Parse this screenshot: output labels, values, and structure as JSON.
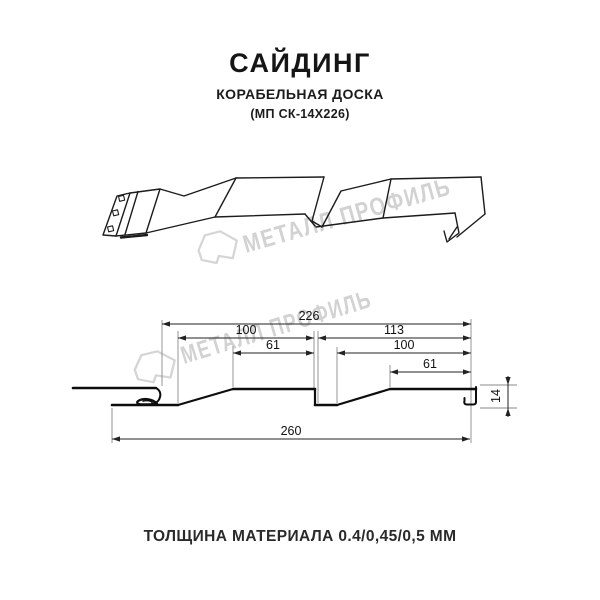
{
  "header": {
    "title": "САЙДИНГ",
    "subtitle": "КОРАБЕЛЬНАЯ ДОСКА",
    "model": "(МП СК-14Х226)"
  },
  "watermark": {
    "brand": "МЕТАЛЛ ПРОФИЛЬ",
    "color": "#d2d2d2"
  },
  "drawing": {
    "type": "siding profile cross-section with dimensions",
    "line_color": "#111111",
    "dimensions": {
      "overall_top": "226",
      "left_board_width": "100",
      "right_board_width": "113",
      "left_face_width": "61",
      "right_board_inner": "100",
      "right_face_width": "61",
      "overall_bottom": "260",
      "profile_height": "14"
    }
  },
  "footer": {
    "thickness_label": "ТОЛЩИНА МАТЕРИАЛА 0.4/0,45/0,5 ММ"
  }
}
